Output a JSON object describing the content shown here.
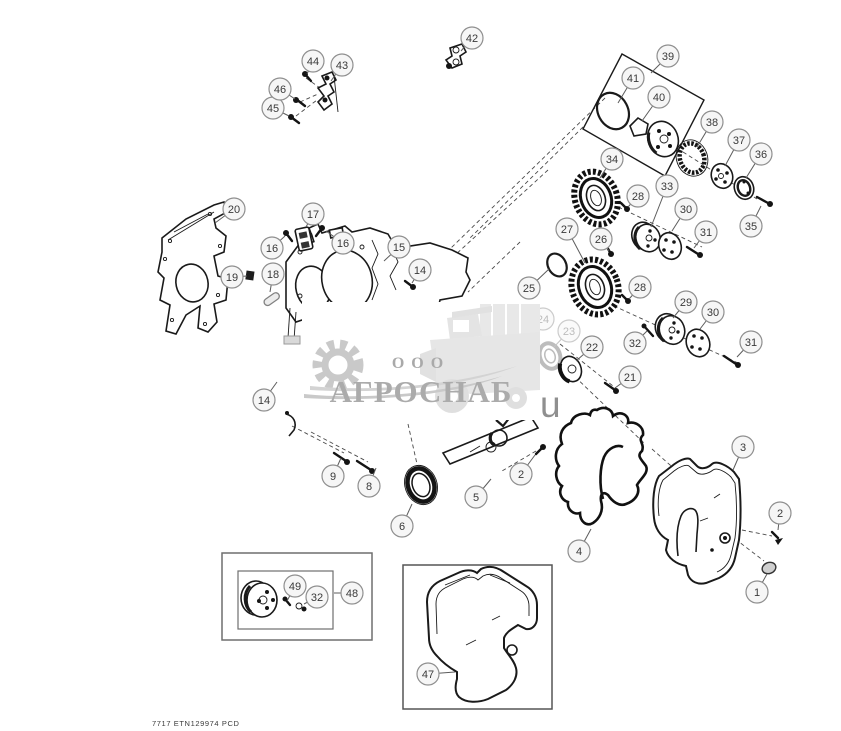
{
  "page": {
    "background": "#ffffff",
    "line_color": "#1a1a1a",
    "callout_stroke": "#8f8f8f"
  },
  "footer": {
    "code": "7717 ETN129974 PCD"
  },
  "watermark": {
    "org_type": "ООО",
    "name": "АГРОСНАБ",
    "suffix": "u",
    "color": "#ababab"
  },
  "diagram": {
    "type": "exploded-parts-diagram",
    "callouts": [
      {
        "n": "1",
        "x": 757,
        "y": 592,
        "lx": 767,
        "ly": 574
      },
      {
        "n": "2",
        "x": 780,
        "y": 513,
        "lx": 778,
        "ly": 530
      },
      {
        "n": "2",
        "x": 521,
        "y": 474,
        "lx": 535,
        "ly": 455
      },
      {
        "n": "3",
        "x": 743,
        "y": 447,
        "lx": 733,
        "ly": 470
      },
      {
        "n": "4",
        "x": 579,
        "y": 551,
        "lx": 591,
        "ly": 529
      },
      {
        "n": "5",
        "x": 476,
        "y": 497,
        "lx": 491,
        "ly": 479
      },
      {
        "n": "6",
        "x": 402,
        "y": 526,
        "lx": 412,
        "ly": 504
      },
      {
        "n": "8",
        "x": 369,
        "y": 486,
        "lx": 376,
        "ly": 468
      },
      {
        "n": "9",
        "x": 333,
        "y": 476,
        "lx": 341,
        "ly": 458
      },
      {
        "n": "14",
        "x": 420,
        "y": 270,
        "lx": 412,
        "ly": 283
      },
      {
        "n": "14",
        "x": 264,
        "y": 400,
        "lx": 277,
        "ly": 382
      },
      {
        "n": "15",
        "x": 399,
        "y": 247,
        "lx": 384,
        "ly": 261
      },
      {
        "n": "16",
        "x": 272,
        "y": 248,
        "lx": 285,
        "ly": 236
      },
      {
        "n": "16",
        "x": 343,
        "y": 243,
        "lx": 326,
        "ly": 231
      },
      {
        "n": "17",
        "x": 313,
        "y": 214,
        "lx": 306,
        "ly": 227
      },
      {
        "n": "18",
        "x": 273,
        "y": 274,
        "lx": 270,
        "ly": 292
      },
      {
        "n": "19",
        "x": 232,
        "y": 277,
        "lx": 247,
        "ly": 276
      },
      {
        "n": "20",
        "x": 234,
        "y": 209,
        "lx": 215,
        "ly": 223
      },
      {
        "n": "21",
        "x": 630,
        "y": 377,
        "lx": 615,
        "ly": 388
      },
      {
        "n": "22",
        "x": 592,
        "y": 347,
        "lx": 576,
        "ly": 361
      },
      {
        "n": "23",
        "x": 569,
        "y": 331,
        "lx": 554,
        "ly": 347,
        "faded": true
      },
      {
        "n": "24",
        "x": 543,
        "y": 319,
        "lx": 533,
        "ly": 332,
        "faded": true
      },
      {
        "n": "25",
        "x": 529,
        "y": 288,
        "lx": 549,
        "ly": 269
      },
      {
        "n": "26",
        "x": 601,
        "y": 239,
        "lx": 609,
        "ly": 251
      },
      {
        "n": "27",
        "x": 567,
        "y": 229,
        "lx": 585,
        "ly": 263
      },
      {
        "n": "28",
        "x": 638,
        "y": 196,
        "lx": 628,
        "ly": 207
      },
      {
        "n": "28",
        "x": 640,
        "y": 287,
        "lx": 629,
        "ly": 299
      },
      {
        "n": "29",
        "x": 686,
        "y": 302,
        "lx": 673,
        "ly": 318
      },
      {
        "n": "30",
        "x": 686,
        "y": 209,
        "lx": 672,
        "ly": 231
      },
      {
        "n": "30",
        "x": 713,
        "y": 312,
        "lx": 700,
        "ly": 329
      },
      {
        "n": "31",
        "x": 706,
        "y": 232,
        "lx": 694,
        "ly": 248
      },
      {
        "n": "31",
        "x": 751,
        "y": 342,
        "lx": 737,
        "ly": 357
      },
      {
        "n": "32",
        "x": 635,
        "y": 343,
        "lx": 647,
        "ly": 331
      },
      {
        "n": "32",
        "x": 317,
        "y": 597,
        "lx": 304,
        "ly": 604
      },
      {
        "n": "33",
        "x": 667,
        "y": 186,
        "lx": 651,
        "ly": 227
      },
      {
        "n": "34",
        "x": 612,
        "y": 159,
        "lx": 600,
        "ly": 178
      },
      {
        "n": "35",
        "x": 751,
        "y": 226,
        "lx": 761,
        "ly": 206
      },
      {
        "n": "36",
        "x": 761,
        "y": 154,
        "lx": 746,
        "ly": 178
      },
      {
        "n": "37",
        "x": 739,
        "y": 140,
        "lx": 725,
        "ly": 166
      },
      {
        "n": "38",
        "x": 712,
        "y": 122,
        "lx": 697,
        "ly": 147
      },
      {
        "n": "39",
        "x": 668,
        "y": 56,
        "lx": 651,
        "ly": 73
      },
      {
        "n": "40",
        "x": 659,
        "y": 97,
        "lx": 642,
        "ly": 121
      },
      {
        "n": "41",
        "x": 633,
        "y": 78,
        "lx": 618,
        "ly": 103
      },
      {
        "n": "42",
        "x": 472,
        "y": 38,
        "lx": 461,
        "ly": 51
      },
      {
        "n": "43",
        "x": 342,
        "y": 65,
        "lx": 331,
        "ly": 81
      },
      {
        "n": "44",
        "x": 313,
        "y": 61,
        "lx": 307,
        "ly": 74
      },
      {
        "n": "45",
        "x": 273,
        "y": 108,
        "lx": 289,
        "ly": 116
      },
      {
        "n": "46",
        "x": 280,
        "y": 89,
        "lx": 295,
        "ly": 99
      },
      {
        "n": "47",
        "x": 428,
        "y": 674,
        "lx": 455,
        "ly": 672
      },
      {
        "n": "48",
        "x": 352,
        "y": 593,
        "lx": 334,
        "ly": 593
      },
      {
        "n": "49",
        "x": 295,
        "y": 586,
        "lx": 287,
        "ly": 601
      }
    ]
  }
}
